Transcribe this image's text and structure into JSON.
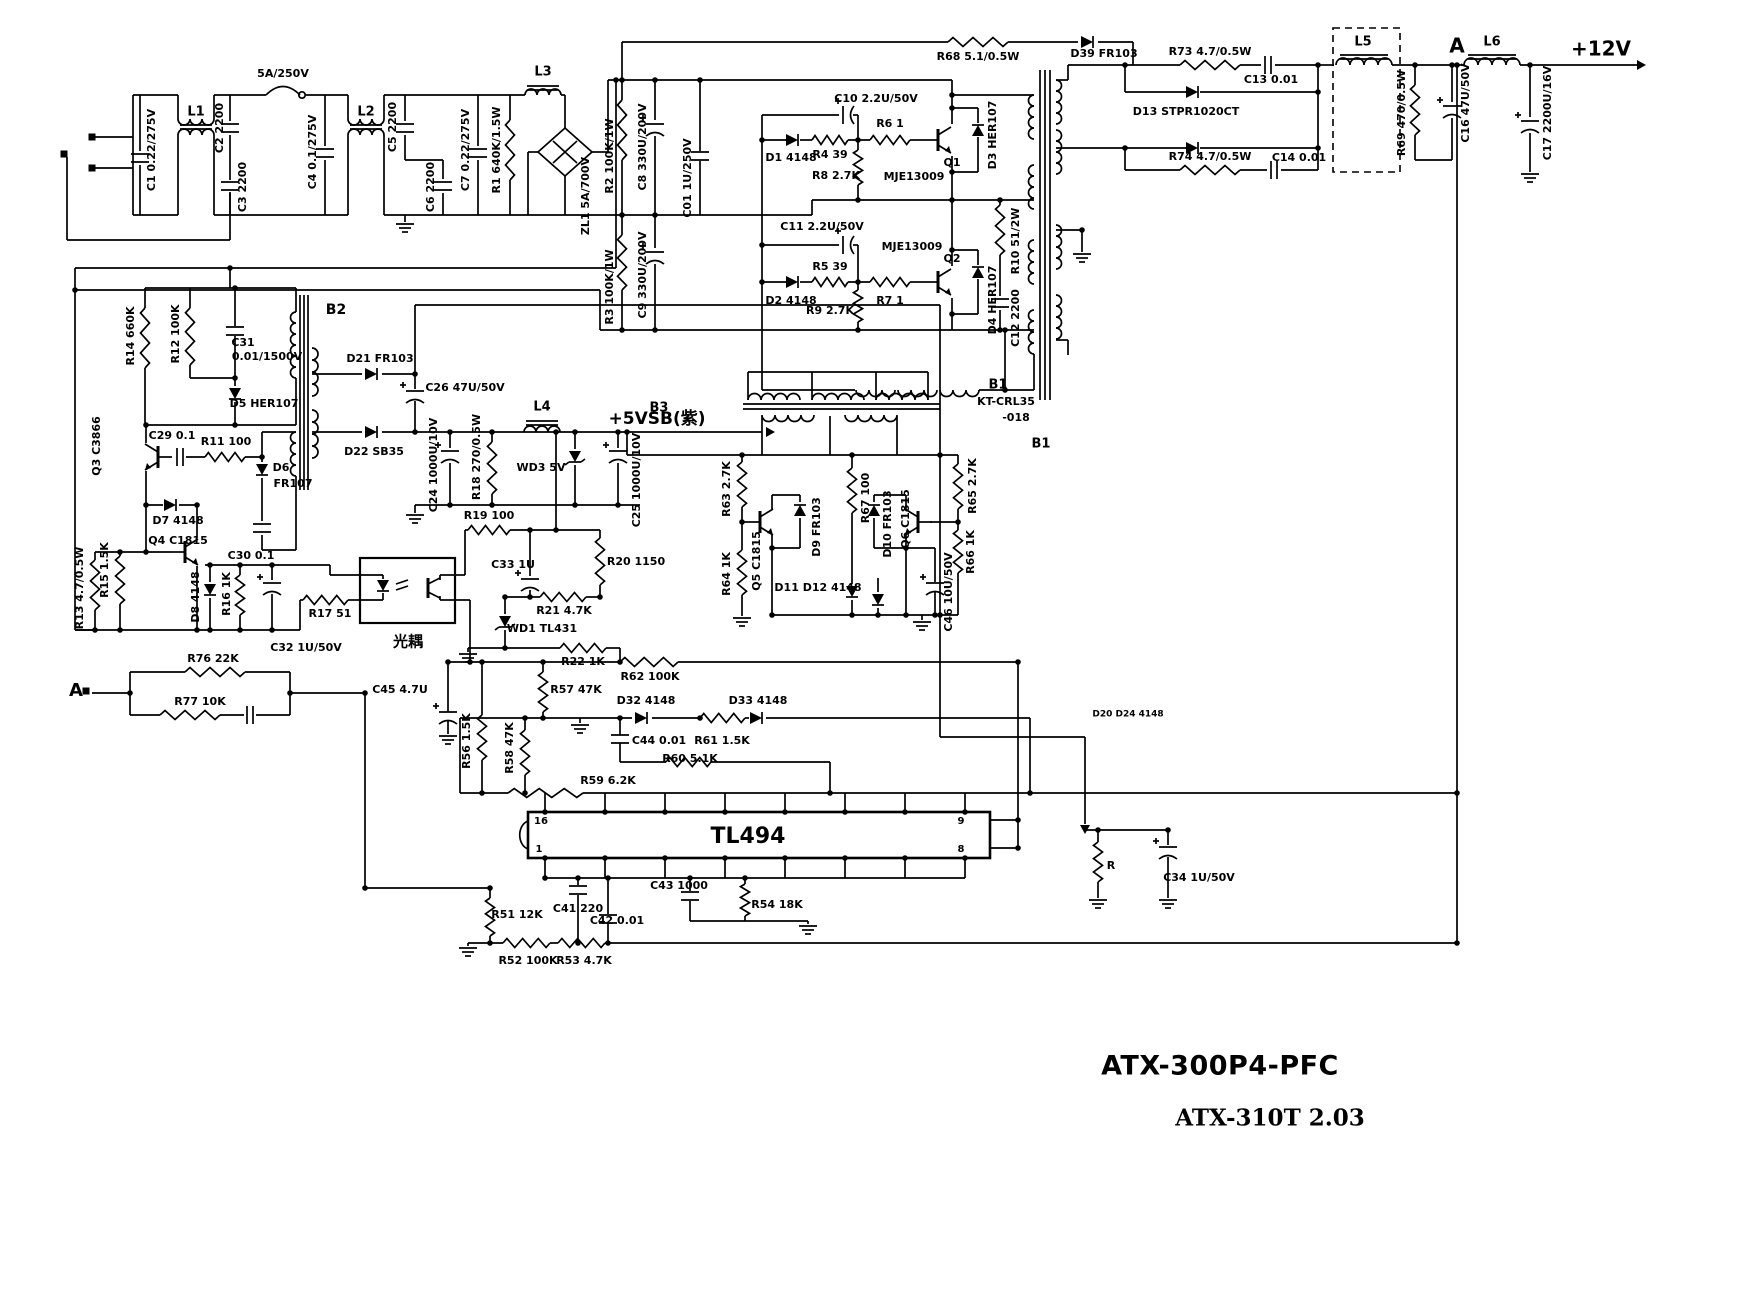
{
  "footer": {
    "model": "ATX-300P4-PFC",
    "revision": "ATX-310T 2.03"
  },
  "schematic": {
    "labels": [
      [
        "5A/250V",
        283,
        74,
        0,
        11
      ],
      [
        "L1",
        196,
        112,
        0,
        13
      ],
      [
        "L2",
        366,
        112,
        0,
        13
      ],
      [
        "L3",
        543,
        72,
        0,
        13
      ],
      [
        "D1 4148",
        791,
        158,
        0,
        11
      ],
      [
        "C10 2.2U/50V",
        876,
        99,
        0,
        11
      ],
      [
        "R4 39",
        830,
        155,
        0,
        11
      ],
      [
        "R8 2.7K",
        836,
        176,
        0,
        11
      ],
      [
        "R6 1",
        890,
        124,
        0,
        11
      ],
      [
        "Q1",
        952,
        163,
        0,
        11
      ],
      [
        "MJE13009",
        914,
        177,
        0,
        11
      ],
      [
        "C11 2.2U/50V",
        822,
        227,
        0,
        11
      ],
      [
        "R5 39",
        830,
        267,
        0,
        11
      ],
      [
        "D2 4148",
        791,
        301,
        0,
        11
      ],
      [
        "R7 1",
        890,
        301,
        0,
        11
      ],
      [
        "MJE13009",
        912,
        247,
        0,
        11
      ],
      [
        "Q2",
        952,
        259,
        0,
        11
      ],
      [
        "R9 2.7K",
        830,
        311,
        0,
        11
      ],
      [
        "R68 5.1/0.5W",
        978,
        57,
        0,
        11
      ],
      [
        "D39 FR103",
        1104,
        54,
        0,
        11
      ],
      [
        "R73 4.7/0.5W",
        1210,
        52,
        0,
        11
      ],
      [
        "C13 0.01",
        1271,
        80,
        0,
        11
      ],
      [
        "D13 STPR1020CT",
        1186,
        112,
        0,
        11
      ],
      [
        "R74 4.7/0.5W",
        1210,
        157,
        0,
        11
      ],
      [
        "C14 0.01",
        1299,
        158,
        0,
        11
      ],
      [
        "L5",
        1363,
        42,
        0,
        13
      ],
      [
        "A",
        1457,
        47,
        0,
        20
      ],
      [
        "L6",
        1492,
        42,
        0,
        13
      ],
      [
        "+12V",
        1601,
        50,
        0,
        20
      ],
      [
        "B2",
        336,
        310,
        0,
        14
      ],
      [
        "C31",
        243,
        343,
        0,
        11
      ],
      [
        "0.01/1500V",
        267,
        357,
        0,
        11
      ],
      [
        "D5 HER107",
        264,
        404,
        0,
        11
      ],
      [
        "C29 0.1",
        172,
        436,
        0,
        11
      ],
      [
        "R11 100",
        226,
        442,
        0,
        11
      ],
      [
        "D6",
        281,
        468,
        0,
        11
      ],
      [
        "FR107",
        293,
        484,
        0,
        11
      ],
      [
        "D7 4148",
        178,
        521,
        0,
        11
      ],
      [
        "Q4 C1815",
        178,
        541,
        0,
        11
      ],
      [
        "C30 0.1",
        251,
        556,
        0,
        11
      ],
      [
        "D21 FR103",
        380,
        359,
        0,
        11
      ],
      [
        "C26 47U/50V",
        465,
        388,
        0,
        11
      ],
      [
        "D22 SB35",
        374,
        452,
        0,
        11
      ],
      [
        "L4",
        542,
        407,
        0,
        13
      ],
      [
        "+5VSB(紫)",
        657,
        419,
        0,
        17
      ],
      [
        "WD3 5V",
        541,
        468,
        0,
        11
      ],
      [
        "R19 100",
        489,
        516,
        0,
        11
      ],
      [
        "R20 1150",
        636,
        562,
        0,
        11
      ],
      [
        "C33 1U",
        513,
        565,
        0,
        11
      ],
      [
        "R21 4.7K",
        564,
        611,
        0,
        11
      ],
      [
        "WD1 TL431",
        542,
        629,
        0,
        11
      ],
      [
        "R22 1K",
        583,
        662,
        0,
        11
      ],
      [
        "R17 51",
        330,
        614,
        0,
        11
      ],
      [
        "C32 1U/50V",
        306,
        648,
        0,
        11
      ],
      [
        "光耦",
        408,
        642,
        0,
        15
      ],
      [
        "R76 22K",
        213,
        659,
        0,
        11
      ],
      [
        "R77 10K",
        200,
        702,
        0,
        11
      ],
      [
        "R57 47K",
        576,
        690,
        0,
        11
      ],
      [
        "R62 100K",
        650,
        677,
        0,
        11
      ],
      [
        "D32 4148",
        646,
        701,
        0,
        11
      ],
      [
        "D33 4148",
        758,
        701,
        0,
        11
      ],
      [
        "C44 0.01",
        659,
        741,
        0,
        11
      ],
      [
        "R61 1.5K",
        722,
        741,
        0,
        11
      ],
      [
        "R60 5.1K",
        690,
        759,
        0,
        11
      ],
      [
        "R59 6.2K",
        608,
        781,
        0,
        11
      ],
      [
        "C45 4.7U",
        400,
        690,
        0,
        11
      ],
      [
        "16",
        541,
        821,
        0,
        10
      ],
      [
        "1",
        539,
        849,
        0,
        10
      ],
      [
        "TL494",
        748,
        837,
        0,
        22
      ],
      [
        "9",
        961,
        821,
        0,
        10
      ],
      [
        "8",
        961,
        849,
        0,
        10
      ],
      [
        "C41 220",
        578,
        909,
        0,
        11
      ],
      [
        "C42 0.01",
        617,
        921,
        0,
        11
      ],
      [
        "R51 12K",
        517,
        915,
        0,
        11
      ],
      [
        "R52 100K",
        528,
        961,
        0,
        11
      ],
      [
        "R53 4.7K",
        584,
        961,
        0,
        11
      ],
      [
        "C43 1000",
        679,
        886,
        0,
        11
      ],
      [
        "R54 18K",
        777,
        905,
        0,
        11
      ],
      [
        "C34 1U/50V",
        1199,
        878,
        0,
        11
      ],
      [
        "R",
        1111,
        866,
        0,
        11
      ],
      [
        "A",
        76,
        691,
        0,
        18
      ],
      [
        "B1",
        998,
        385,
        0,
        13
      ],
      [
        "KT-CRL35",
        1006,
        402,
        0,
        11
      ],
      [
        "-018",
        1016,
        418,
        0,
        11
      ],
      [
        "B1",
        1041,
        444,
        0,
        13
      ],
      [
        "B3",
        659,
        408,
        0,
        13
      ],
      [
        "D11 D12 4148",
        818,
        588,
        0,
        11
      ],
      [
        "D20 D24 4148",
        1128,
        714,
        0,
        9
      ],
      [
        "C1 0.22/275V",
        152,
        150,
        -90,
        11
      ],
      [
        "C2 2200",
        220,
        128,
        -90,
        11
      ],
      [
        "C3 2200",
        243,
        187,
        -90,
        11
      ],
      [
        "C4 0.1/275V",
        313,
        152,
        -90,
        11
      ],
      [
        "C5 2200",
        393,
        127,
        -90,
        11
      ],
      [
        "C6 2200",
        431,
        187,
        -90,
        11
      ],
      [
        "C7 0.22/275V",
        466,
        150,
        -90,
        11
      ],
      [
        "R1 640K/1.5W",
        497,
        150,
        -90,
        11
      ],
      [
        "ZL1 5A/700V",
        586,
        196,
        -90,
        11
      ],
      [
        "R2 100K/1W",
        610,
        156,
        -90,
        11
      ],
      [
        "C8 330U/200V",
        643,
        147,
        -90,
        11
      ],
      [
        "C01 1U/250V",
        688,
        178,
        -90,
        11
      ],
      [
        "R3 100K/1W",
        610,
        287,
        -90,
        11
      ],
      [
        "C9 330U/200V",
        643,
        275,
        -90,
        11
      ],
      [
        "D3 HER107",
        993,
        135,
        -90,
        11
      ],
      [
        "D4 HER107",
        993,
        300,
        -90,
        11
      ],
      [
        "R10 51/2W",
        1016,
        241,
        -90,
        11
      ],
      [
        "C12 2200",
        1016,
        318,
        -90,
        11
      ],
      [
        "R69 470/0.5W",
        1402,
        113,
        -90,
        11
      ],
      [
        "C16 47U/50V",
        1466,
        103,
        -90,
        11
      ],
      [
        "C17 2200U/16V",
        1548,
        113,
        -90,
        11
      ],
      [
        "R14 660K",
        131,
        336,
        -90,
        11
      ],
      [
        "R12 100K",
        176,
        334,
        -90,
        11
      ],
      [
        "Q3 C3866",
        97,
        446,
        -90,
        11
      ],
      [
        "R15 1.5K",
        105,
        570,
        -90,
        11
      ],
      [
        "R13 4.7/0.5W",
        80,
        588,
        -90,
        11
      ],
      [
        "D8 4148",
        196,
        597,
        -90,
        11
      ],
      [
        "R16 1K",
        227,
        594,
        -90,
        11
      ],
      [
        "C24 1000U/10V",
        434,
        465,
        -90,
        11
      ],
      [
        "R18 270/0.5W",
        477,
        457,
        -90,
        11
      ],
      [
        "C25 1000U/10V",
        637,
        480,
        -90,
        11
      ],
      [
        "R63 2.7K",
        727,
        489,
        -90,
        11
      ],
      [
        "R64 1K",
        727,
        574,
        -90,
        11
      ],
      [
        "Q5 C1815",
        757,
        561,
        -90,
        11
      ],
      [
        "D9 FR103",
        817,
        527,
        -90,
        11
      ],
      [
        "R67 100",
        866,
        498,
        -90,
        11
      ],
      [
        "D10 FR103",
        888,
        524,
        -90,
        11
      ],
      [
        "Q6 C1815",
        906,
        519,
        -90,
        11
      ],
      [
        "R65 2.7K",
        973,
        486,
        -90,
        11
      ],
      [
        "R66 1K",
        971,
        552,
        -90,
        11
      ],
      [
        "C46 10U/50V",
        949,
        592,
        -90,
        11
      ],
      [
        "R56 1.5K",
        467,
        741,
        -90,
        11
      ],
      [
        "R58 47K",
        510,
        748,
        -90,
        11
      ]
    ]
  }
}
